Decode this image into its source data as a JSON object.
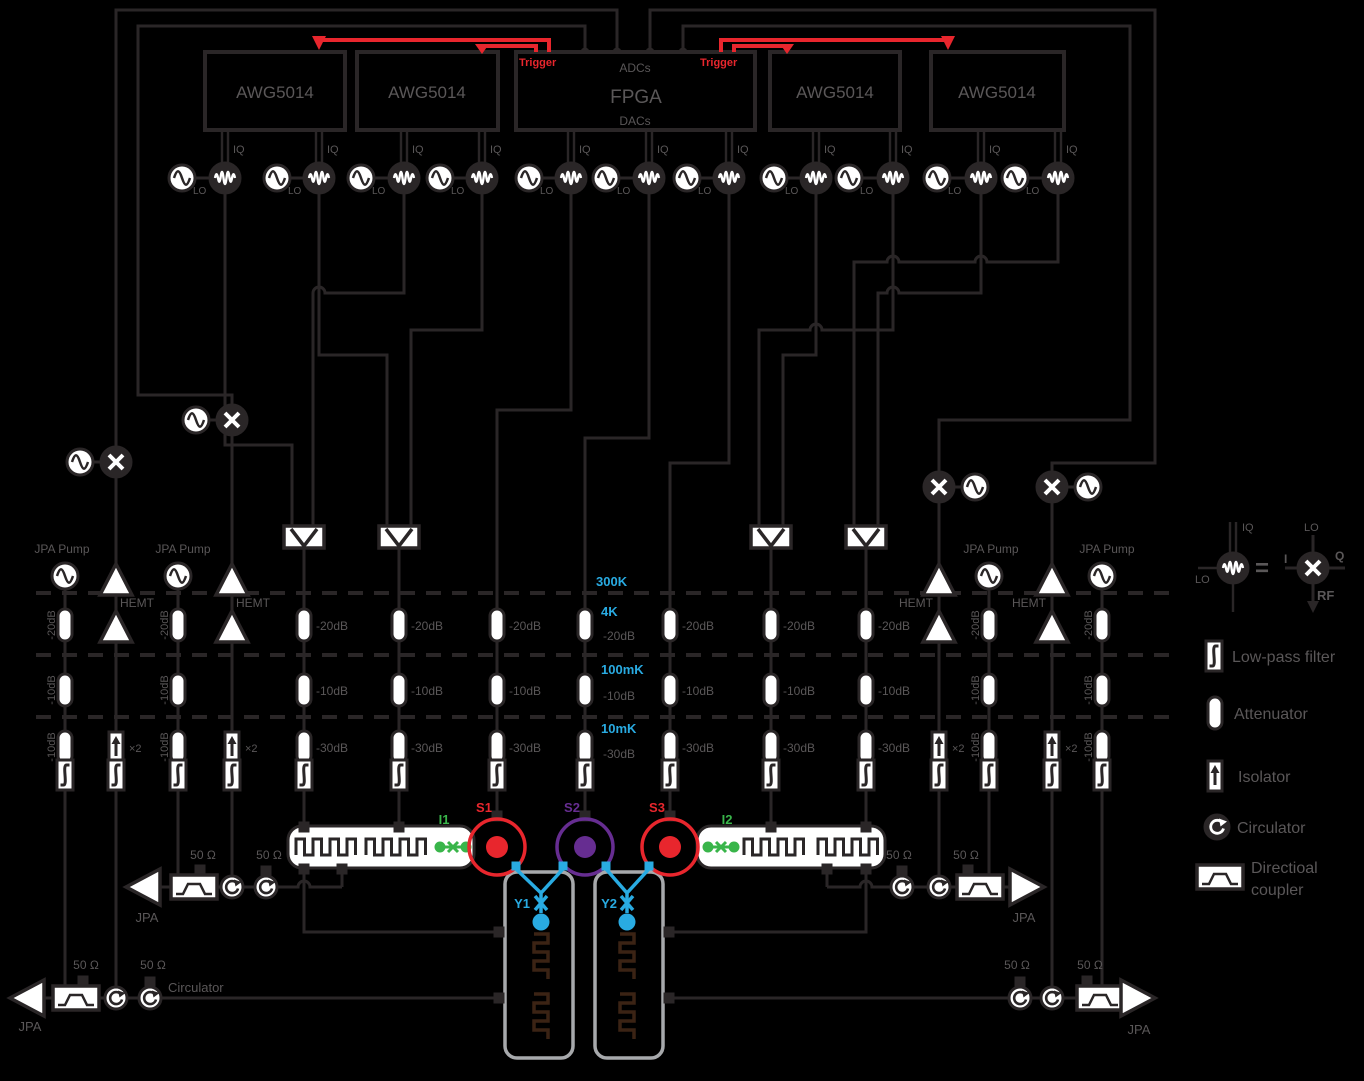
{
  "instruments": {
    "awg": "AWG5014",
    "fpga": "FPGA",
    "adcs": "ADCs",
    "dacs": "DACs"
  },
  "trigger": "Trigger",
  "ports": {
    "iq": "IQ",
    "lo": "LO"
  },
  "temps": {
    "t300": "300K",
    "t4": "4K",
    "t100": "100mK",
    "t10": "10mK"
  },
  "atten": {
    "db20": "-20dB",
    "db10": "-10dB",
    "db30": "-30dB"
  },
  "amps": {
    "hemt": "HEMT",
    "jpa": "JPA",
    "pump": "JPA Pump",
    "x2": "×2"
  },
  "term": {
    "ohm": "50 Ω"
  },
  "misc": {
    "circulator": "Circulator"
  },
  "sample": {
    "s1": "S1",
    "s2": "S2",
    "s3": "S3",
    "i1": "I1",
    "i2": "I2",
    "y1": "Y1",
    "y2": "Y2"
  },
  "legend": {
    "iq": "IQ",
    "lo": "LO",
    "eq": "=",
    "i": "I",
    "q": "Q",
    "rf": "RF",
    "lo2": "LO",
    "lpf": "Low-pass filter",
    "att": "Attenuator",
    "iso": "Isolator",
    "circ": "Circulator",
    "coup1": "Directioal",
    "coup2": "coupler"
  },
  "colors": {
    "ink": "#2A2627",
    "text": "#5A5758",
    "red": "#E8262D",
    "cyan": "#29ABE2",
    "green": "#39B54A",
    "purple": "#662D91",
    "gray": "#A7A9AC",
    "brown": "#3B2314",
    "white": "#FFFFFF"
  }
}
